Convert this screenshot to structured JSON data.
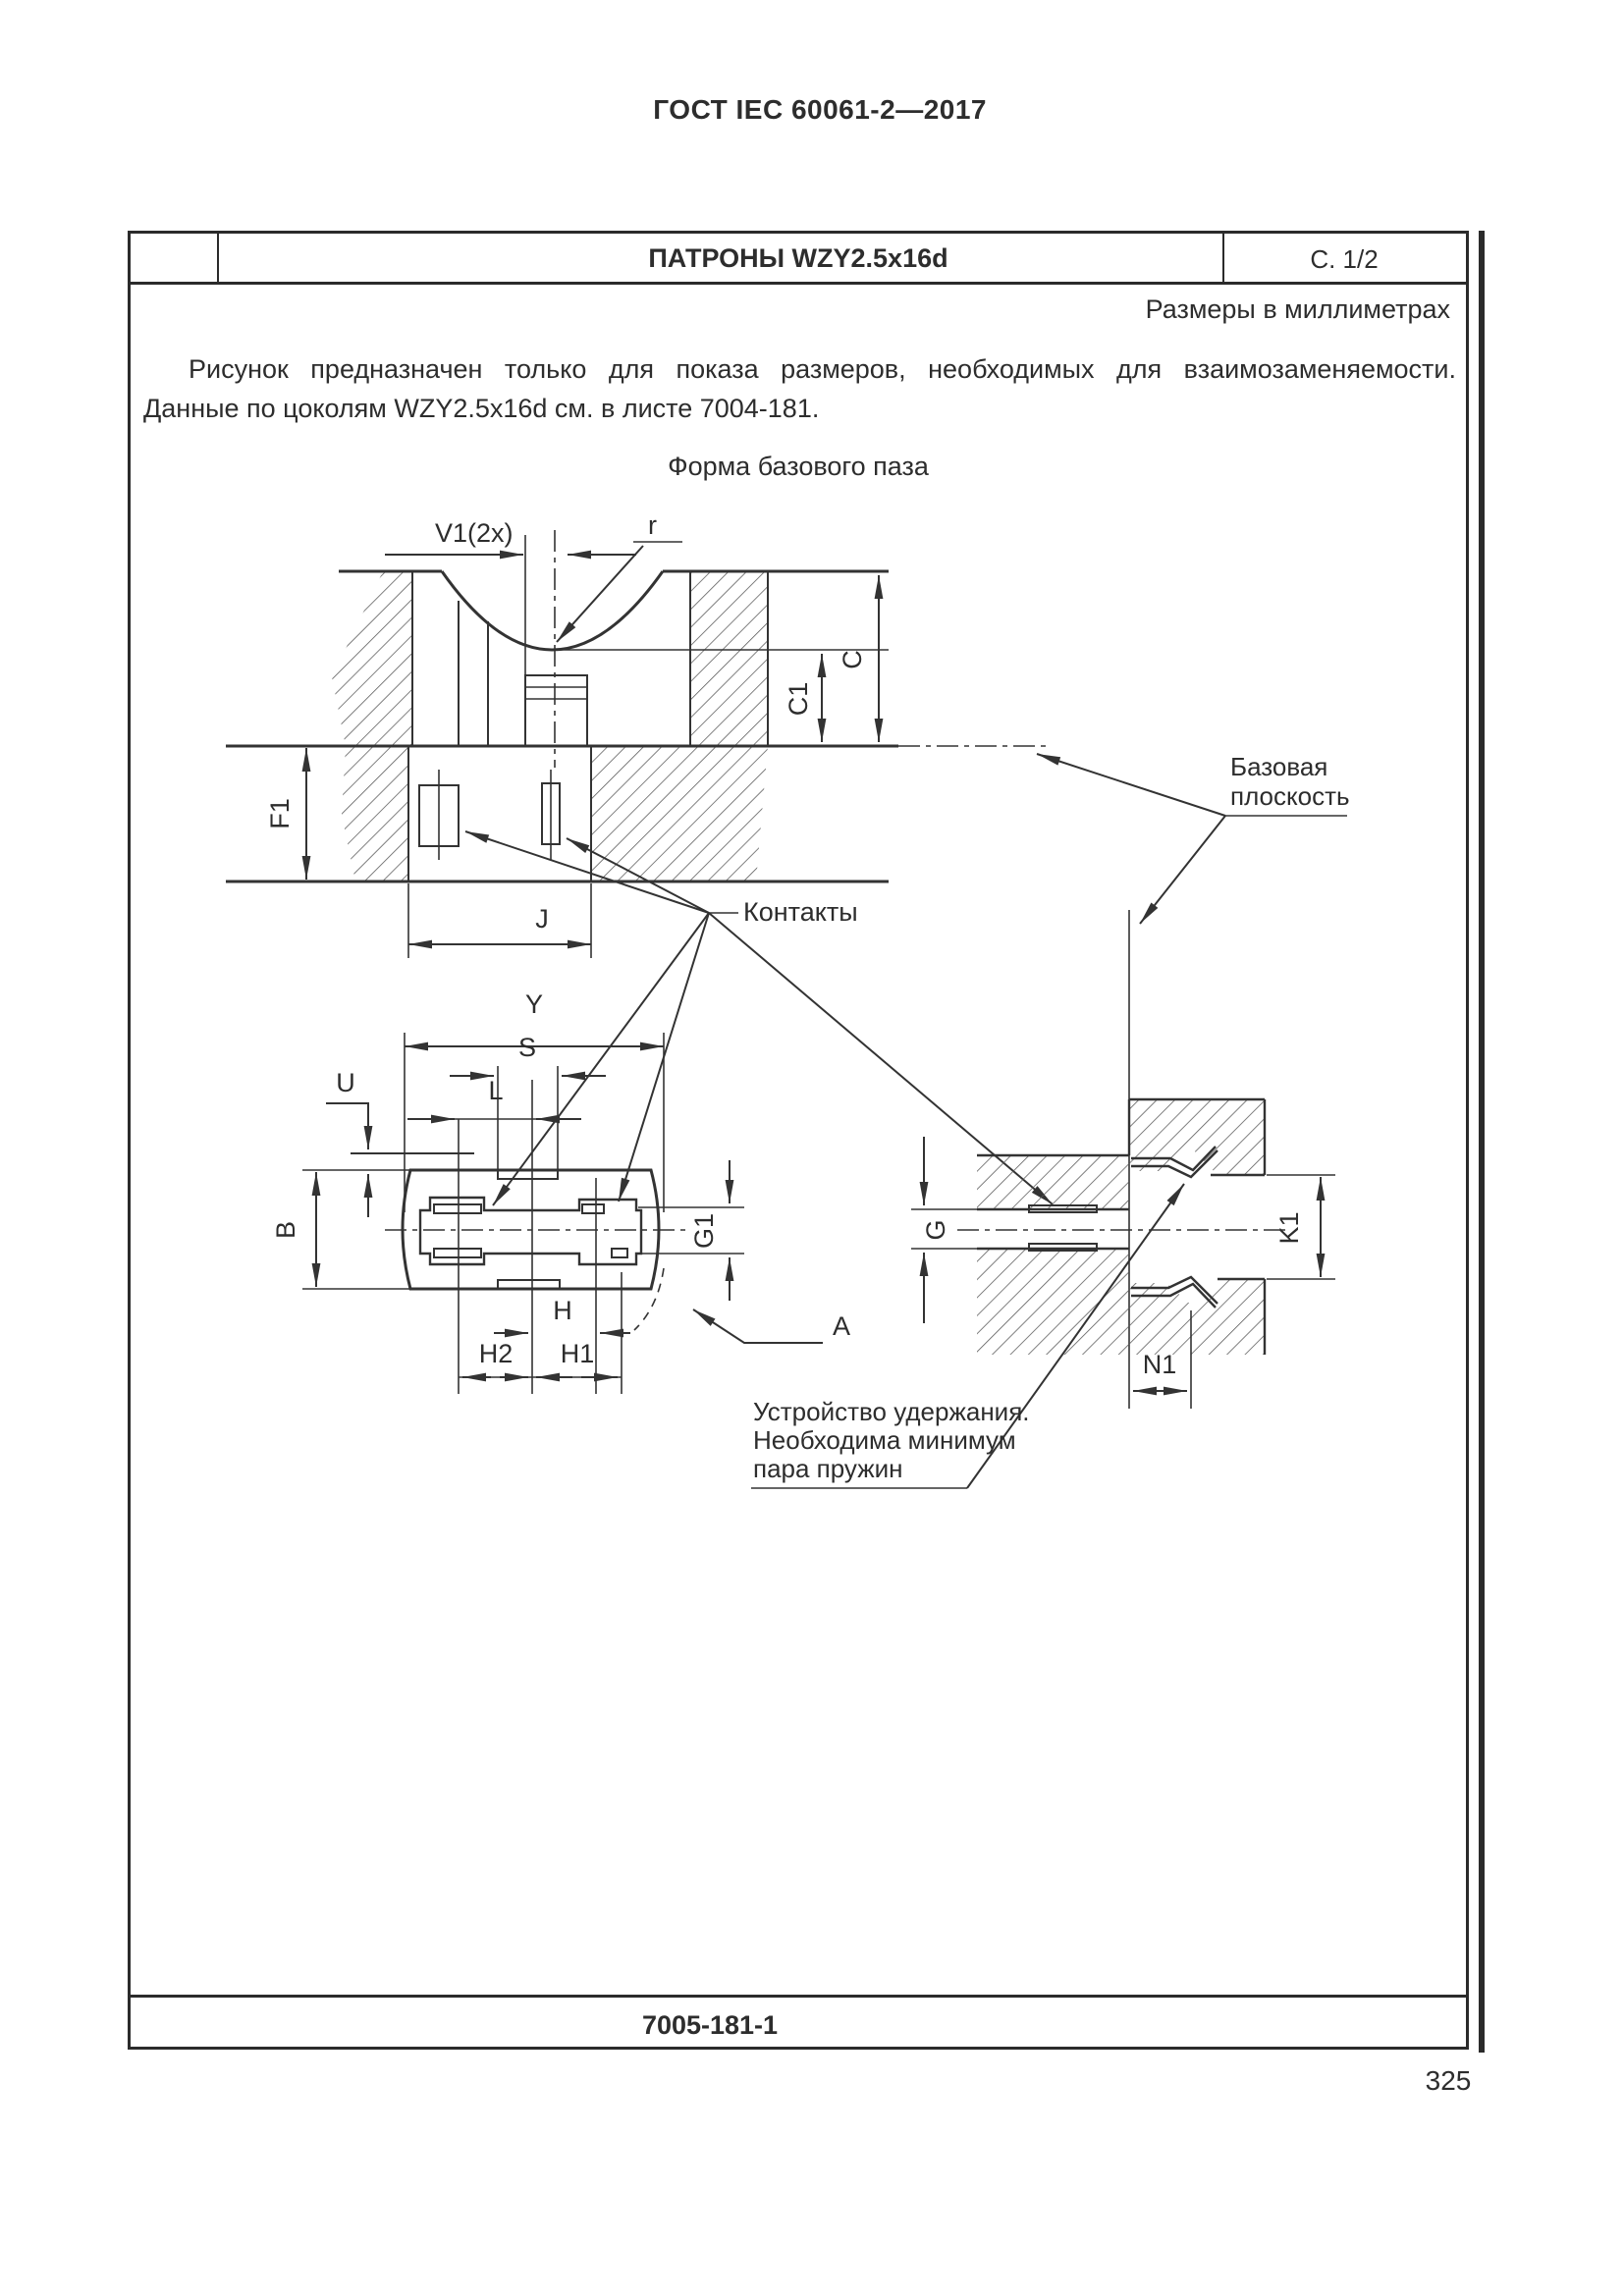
{
  "header": {
    "standard_ref": "ГОСТ IEC 60061-2—2017"
  },
  "title_block": {
    "title": "ПАТРОНЫ WZY2.5x16d",
    "sheet_page": "С. 1/2"
  },
  "notes": {
    "units": "Размеры в миллиметрах",
    "intro_line1": "Рисунок предназначен только для показа размеров, необходимых для взаимозаменяемости.",
    "intro_line2": "Данные по цоколям WZY2.5x16d см. в листе 7004-181.",
    "figure_caption": "Форма базового паза"
  },
  "drawing": {
    "dim_labels": {
      "v1": "V1(2x)",
      "r": "r",
      "c": "C",
      "c1": "C1",
      "f1": "F1",
      "j": "J",
      "y": "Y",
      "s": "S",
      "u": "U",
      "l": "L",
      "b": "B",
      "g1": "G1",
      "h": "H",
      "h2": "H2",
      "h1": "H1",
      "a": "A",
      "g": "G",
      "k1": "K1",
      "n1": "N1"
    },
    "annotations": {
      "base_plane_line1": "Базовая",
      "base_plane_line2": "плоскость",
      "contacts": "Контакты",
      "retention_line1": "Устройство удержания.",
      "retention_line2": "Необходима минимум",
      "retention_line3": "пара пружин"
    }
  },
  "footer": {
    "sheet_number": "7005-181-1",
    "page_number": "325"
  },
  "colors": {
    "ink": "#2d2d2d",
    "line": "#333333"
  }
}
